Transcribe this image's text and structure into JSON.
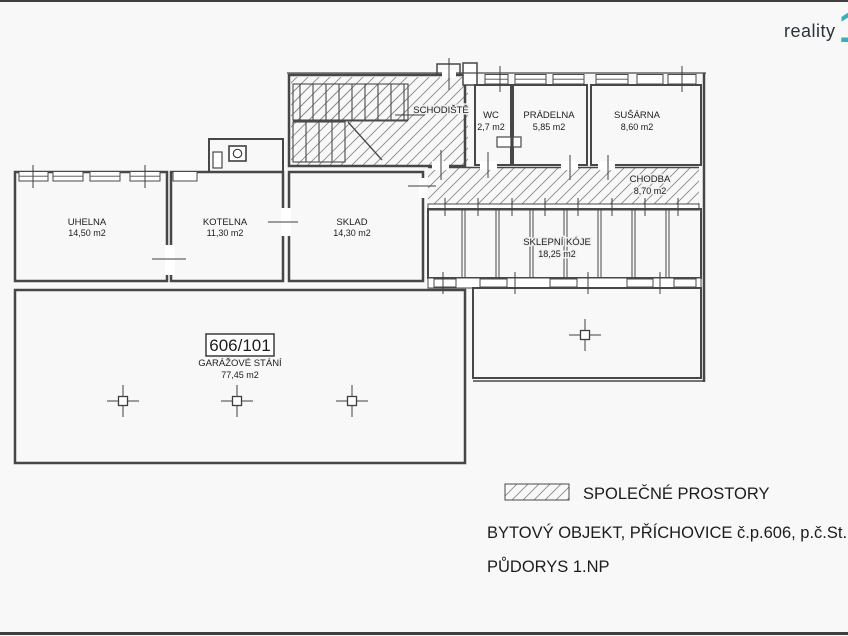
{
  "logo": {
    "text": "reality",
    "mark": "1",
    "text_color": "#2c3134",
    "accent_color": "#42abb5"
  },
  "plan": {
    "rooms": {
      "uhelna": {
        "name": "UHELNA",
        "area": "14,50 m2"
      },
      "kotelna": {
        "name": "KOTELNA",
        "area": "11,30 m2"
      },
      "sklad": {
        "name": "SKLAD",
        "area": "14,30 m2"
      },
      "schodiste": {
        "name": "SCHODIŠTĚ"
      },
      "wc": {
        "name": "WC",
        "area": "2,7 m2"
      },
      "pradelna": {
        "name": "PRÁDELNA",
        "area": "5,85 m2"
      },
      "susarna": {
        "name": "SUŠÁRNA",
        "area": "8,60 m2"
      },
      "chodba": {
        "name": "CHODBA",
        "area": "8,70 m2"
      },
      "sklepni_koje": {
        "name": "SKLEPNÍ KÓJE",
        "area": "18,25 m2"
      }
    },
    "garage": {
      "unit": "606/101",
      "name": "GARÁŽOVÉ STÁNÍ",
      "area": "77,45 m2"
    }
  },
  "legend": {
    "hatch_label": "SPOLEČNÉ PROSTORY",
    "building_label": "BYTOVÝ OBJEKT, PŘÍCHOVICE č.p.606, p.č.St. 802",
    "floor_label": "PŮDORYS 1.NP"
  }
}
